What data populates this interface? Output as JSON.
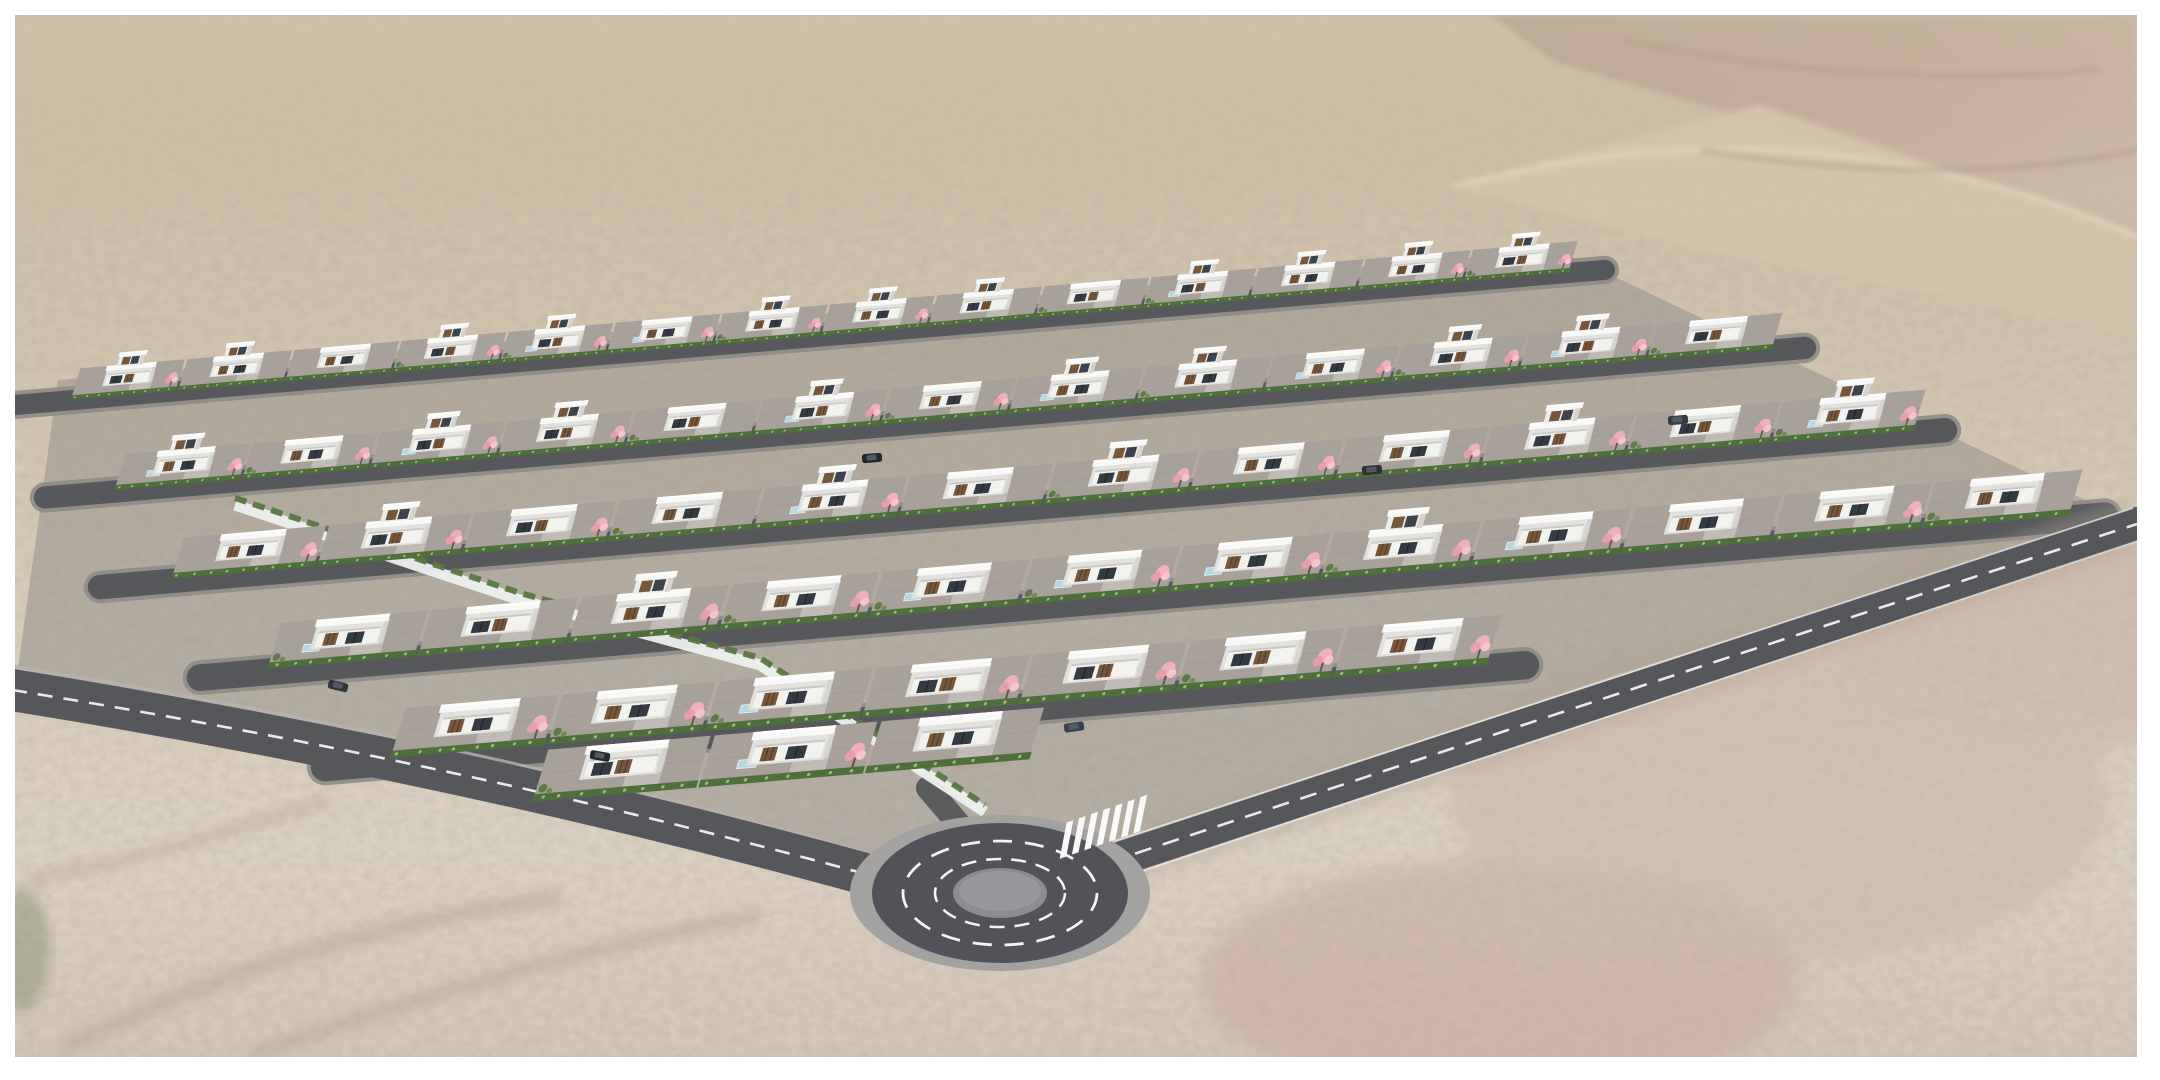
{
  "page": {
    "background": "#ffffff",
    "frame": {
      "x": 15,
      "y": 15,
      "width": 2122,
      "height": 1042
    }
  },
  "scene": {
    "type": "architectural-3d-rendering",
    "subject": "Aerial rendering of a modern white-villa housing development with roundabout in a desert landscape",
    "features": [
      "desert terrain",
      "rocky ridge",
      "housing estate",
      "white flat-roof villas",
      "wood slat facades",
      "pink blossom trees",
      "privacy hedges",
      "retaining wall",
      "internal streets",
      "perimeter road",
      "access road",
      "roundabout",
      "zebra crosswalk",
      "parked cars",
      "pools"
    ],
    "counts": {
      "house_rows": 6,
      "houses": 61,
      "crosswalk_stripes": 7,
      "cars": 6
    },
    "terrain": {
      "top": "#c2b29a",
      "upper": "#cfc1aa",
      "mid": "#d8ccb9",
      "low": "#dcd2c4",
      "pink_low": "#d2c1b5",
      "speckle": "#6e6250",
      "haze": "#d8cab0",
      "ridge_rock": "#997f72",
      "ridge_rock_light": "#b49a8c",
      "ridge_sand": "#d3c4ab",
      "ridge_highlight": "#e7dcc4",
      "wash": "#b1a28b",
      "green_patch": "#6c7f52"
    },
    "estate": {
      "slope": -0.085,
      "shear": -0.3,
      "base_fill": "#95918b",
      "palette": {
        "plot": "#a7a19a",
        "plot_line": "#9b958e",
        "drive": "#c0bcb5",
        "shadow": "#8e8a84",
        "hedge": "#4e6e3c",
        "hedge_light": "#a9c47e",
        "roof": "#f8f8f6",
        "fascia": "#fdfdfc",
        "wall_side": "#e2e1dd",
        "wall_far": "#d5d4cf",
        "facade": "#f2f2ef",
        "under_roof": "#c9c8c3",
        "wood": "#77573c",
        "wood_dark": "#5a4128",
        "glass": "#343a41",
        "pool": "#b7d7e3",
        "pool_edge": "#eaf4f8",
        "blossom": "#eeb0ba",
        "blossom_dark": "#e79fac",
        "blossom_light": "#f4c5cd",
        "trunk": "#6b5340",
        "bush": "#5f7a47",
        "bush_light": "#6f8a55",
        "wall_white": "#eef0ef"
      },
      "rows": [
        {
          "x0": 60,
          "y0": 370,
          "x1": 1560,
          "count": 14,
          "scale": 0.64,
          "two_story": [
            1,
            1,
            0,
            1,
            1,
            0,
            1,
            1,
            1,
            0,
            1,
            1,
            1,
            1
          ]
        },
        {
          "x0": 100,
          "y0": 456,
          "x1": 1760,
          "count": 13,
          "scale": 0.74,
          "two_story": [
            1,
            0,
            1,
            1,
            0,
            1,
            0,
            1,
            1,
            0,
            1,
            1,
            0
          ]
        },
        {
          "x0": 155,
          "y0": 540,
          "x1": 1900,
          "count": 12,
          "scale": 0.84,
          "two_story": [
            0,
            1,
            0,
            0,
            1,
            0,
            1,
            0,
            0,
            1,
            0,
            1
          ]
        },
        {
          "x0": 255,
          "y0": 625,
          "x1": 2060,
          "count": 12,
          "scale": 0.94,
          "two_story": [
            0,
            0,
            1,
            0,
            0,
            0,
            0,
            1,
            0,
            0,
            0,
            0
          ]
        },
        {
          "x0": 380,
          "y0": 710,
          "x1": 1480,
          "count": 7,
          "scale": 1.02,
          "two_story": [
            0,
            0,
            0,
            0,
            0,
            0,
            0
          ]
        },
        {
          "x0": 520,
          "y0": 752,
          "x1": 1020,
          "count": 3,
          "scale": 1.06,
          "two_story": [
            0,
            0,
            0
          ]
        }
      ],
      "street": {
        "fill": "#57585c",
        "walk": "#8e8b86"
      },
      "wall": {
        "path": "M 235,505 L 520,600 L 760,665 L 985,812",
        "color": "#eef0ef",
        "hedge_color": "#5a7742"
      }
    },
    "roads": {
      "asphalt": "#56575b",
      "marking": "#f2f2f1",
      "curb": "#b7b4ae",
      "left": {
        "center": "M 12,690 Q 460,762 880,878",
        "width": 42,
        "edge": "M 14,668 Q 460,740 872,856"
      },
      "southeast": {
        "center": "M 1080,872 Q 1620,692 2137,524",
        "width": 34,
        "edge_top": "M 1072,855 Q 1612,676 2133,508",
        "edge_bottom": "M 1088,889 Q 1628,708 2141,540"
      },
      "stub": {
        "center": "M 1008,882 L 928,788",
        "width": 24
      }
    },
    "roundabout": {
      "cx": 1000,
      "cy": 893,
      "apron_rx": 150,
      "apron_ry": 78,
      "apron_fill": "#a3a2a0",
      "ring_rx": 128,
      "ring_ry": 70,
      "ring_fill": "#525358",
      "dash_outer_rx": 97,
      "dash_outer_ry": 52,
      "dash_inner_rx": 65,
      "dash_inner_ry": 34,
      "island_rx": 47,
      "island_ry": 25,
      "island_fill": "#8b8c90",
      "island_top": "#97989c",
      "dash_color": "#f4f4f2"
    },
    "crosswalk": {
      "x": 1100,
      "y": 828,
      "rotate": -19,
      "skew": -30,
      "stripes": 7,
      "stripe_w": 7,
      "stripe_h": 32,
      "gap": 13,
      "color": "#fafafa"
    },
    "cars": [
      {
        "x": 338,
        "y": 686,
        "r": 14,
        "c": "#2f353b"
      },
      {
        "x": 600,
        "y": 756,
        "r": 10,
        "c": "#23282e"
      },
      {
        "x": 872,
        "y": 458,
        "r": -5,
        "c": "#23282e"
      },
      {
        "x": 1678,
        "y": 420,
        "r": -5,
        "c": "#383d44"
      },
      {
        "x": 1372,
        "y": 470,
        "r": -5,
        "c": "#2b3036"
      },
      {
        "x": 1074,
        "y": 727,
        "r": -8,
        "c": "#37414e"
      }
    ]
  }
}
